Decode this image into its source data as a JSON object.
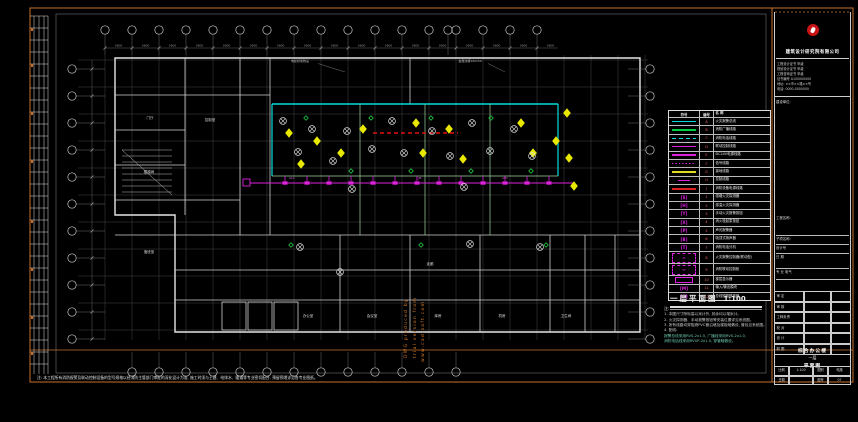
{
  "drawing_title": {
    "text": "一层平面图",
    "scale": "1:100"
  },
  "notes": {
    "heading": "注:",
    "lines": [
      {
        "text": "1. 本图尺寸除标高以米计外, 其余均以毫米计。",
        "teal": false
      },
      {
        "text": "2. 火灾探测器、手动报警按钮等安装位置详见系统图。",
        "teal": false
      },
      {
        "text": "3. 所有线路均穿阻燃PVC管沿墙及楼板暗敷设, 管径见系统图。",
        "teal": false
      },
      {
        "text": "4. 配线:",
        "teal": false
      },
      {
        "text": "报警总线采用RVS-2x1.5, 广播线采用RVS-2x1.0,",
        "teal": true
      },
      {
        "text": "消防电话线采用RVVP-2x1.0, 穿管暗敷设。",
        "teal": true
      }
    ]
  },
  "bottom_note": "注: 本工程所有消防报警及联动控制设备的型号规格以经消防主管部门审批的深化设计为准, 施工时须与土建、给排水、暖通等专业密切配合, 预留预埋详见各专业图纸。",
  "watermark": [
    "DWG produced by",
    "trial version from",
    "www.cad-soft.com"
  ],
  "plan": {
    "dim_label": "3600",
    "room_labels": [
      "门厅",
      "楼梯间",
      "值班室",
      "走廊",
      "办公室",
      "会议室",
      "库房",
      "机房",
      "卫生间",
      "控制室"
    ],
    "equip_labels": [
      "电缆桥架敷设",
      "金属线槽100x50"
    ],
    "panel_labels": [
      "AL1",
      "JB",
      "AP1"
    ]
  },
  "legend": {
    "headers": [
      "符号",
      "编号",
      "名 称"
    ],
    "rows": [
      {
        "code": "A",
        "type": "line",
        "color": "#00dede",
        "glyph": "",
        "name": "火灾报警总线"
      },
      {
        "code": "B",
        "type": "line",
        "color": "#00cc44",
        "glyph": "",
        "name": "消防广播线路"
      },
      {
        "code": "C",
        "type": "dash",
        "color": "#00dede",
        "glyph": "",
        "name": "消防电话线路"
      },
      {
        "code": "D",
        "type": "line",
        "color": "#dd22dd",
        "glyph": "",
        "name": "联动控制线路"
      },
      {
        "code": "E",
        "type": "thick",
        "color": "#dd22dd",
        "glyph": "",
        "name": "DC24V电源线路"
      },
      {
        "code": "F",
        "type": "dot",
        "color": "#dd22dd",
        "glyph": "",
        "name": "信号线路"
      },
      {
        "code": "G",
        "type": "line",
        "color": "#dddd22",
        "glyph": "",
        "name": "接地线路"
      },
      {
        "code": "H",
        "type": "short",
        "color": "#dd22dd",
        "glyph": "",
        "name": "控制线路"
      },
      {
        "code": "J",
        "type": "thick",
        "color": "#dd2222",
        "glyph": "",
        "name": "消防设备电源线路"
      },
      {
        "code": "1",
        "type": "sym",
        "color": "#dd22dd",
        "glyph": "[S]",
        "name": "感烟火灾探测器"
      },
      {
        "code": "2",
        "type": "sym",
        "color": "#dd22dd",
        "glyph": "[H]",
        "name": "感温火灾探测器"
      },
      {
        "code": "3",
        "type": "sym",
        "color": "#dd22dd",
        "glyph": "[Y]",
        "name": "手动火灾报警按钮"
      },
      {
        "code": "4",
        "type": "sym",
        "color": "#dd22dd",
        "glyph": "[X]",
        "name": "消火栓起泵按钮"
      },
      {
        "code": "5",
        "type": "sym",
        "color": "#dd22dd",
        "glyph": "[P]",
        "name": "声光报警器"
      },
      {
        "code": "6",
        "type": "sym",
        "color": "#dd22dd",
        "glyph": "[B]",
        "name": "吸顶式扬声器"
      },
      {
        "code": "7",
        "type": "sym",
        "color": "#dd22dd",
        "glyph": "[T]",
        "name": "消防电话分机"
      },
      {
        "code": "8",
        "type": "dashbox",
        "color": "#dd22dd",
        "glyph": "JB",
        "name": "火灾报警控制器(联动型)"
      },
      {
        "code": "9",
        "type": "dashbox",
        "color": "#dd22dd",
        "glyph": "XF",
        "name": "消防联动控制柜"
      },
      {
        "code": "10",
        "type": "box",
        "color": "#dd22dd",
        "glyph": "",
        "name": "楼层显示器"
      },
      {
        "code": "11",
        "type": "sym",
        "color": "#dd22dd",
        "glyph": "[M]",
        "name": "输入/输出模块"
      },
      {
        "code": "12",
        "type": "sym",
        "color": "#dd22dd",
        "glyph": "[G]",
        "name": "总线短路隔离器"
      }
    ]
  },
  "title_block": {
    "company": "建筑设计研究院有限公司",
    "cert_lines": [
      "工程设计证书 甲级",
      "规划设计证书 甲级",
      "工程咨询证书 甲级",
      "证书编号 A100000000",
      "地址: ××市××路××号",
      "电话: 0000-0000000"
    ],
    "owner_label": "建设单位:",
    "section_labels": [
      "工程名称:",
      "子项名称:",
      "设计号",
      "日 期",
      "专 业  电气"
    ],
    "sign_rows": [
      "审 定",
      "审 核",
      "工种负责",
      "校 对",
      "设 计",
      "制 图"
    ],
    "title_lines": [
      "综合办公楼",
      "一层",
      "平面图"
    ],
    "bottom_cells": [
      [
        "比例",
        "1:100",
        "图别",
        "电施"
      ],
      [
        "日期",
        "",
        "图号",
        "07"
      ]
    ],
    "accent_orange": "#c4702c",
    "logo_red": "#c81414"
  }
}
